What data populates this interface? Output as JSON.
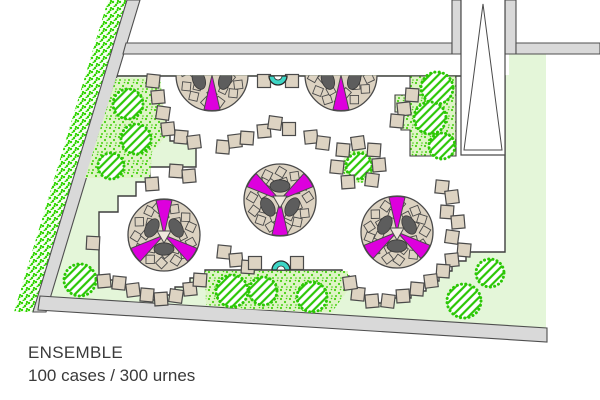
{
  "labels": {
    "title": "ENSEMBLE",
    "subtitle": "100 cases / 300 urnes"
  },
  "colors": {
    "lawn": "#e4f6d9",
    "speckle_bg": "#def4c6",
    "speckle_dot": "#47d112",
    "hedge_dot": "#2fd400",
    "hatch_green": "#2bc705",
    "wall_fill": "#d9d9d9",
    "wall_stroke": "#4f4f4f",
    "boundary": "#3f3f3f",
    "stone": "#ddd3c2",
    "stone_stroke": "#4a4a4a",
    "disc": "#dcd2c1",
    "blob": "#5d5d5d",
    "magenta": "#dd00dd",
    "cyan": "#3dd5c5",
    "white": "#ffffff",
    "text": "#3a3a3a"
  },
  "plan": {
    "lawn": [
      [
        116,
        75
      ],
      [
        509,
        75
      ],
      [
        509,
        54
      ],
      [
        546,
        54
      ],
      [
        546,
        329
      ],
      [
        40,
        297
      ]
    ],
    "walls": {
      "hedge": [
        [
          108,
          0
        ],
        [
          127,
          0
        ],
        [
          33,
          312
        ],
        [
          14,
          312
        ]
      ],
      "street": [
        [
          127,
          0
        ],
        [
          140,
          0
        ],
        [
          46,
          312
        ],
        [
          33,
          312
        ]
      ],
      "top_wall_left": [
        [
          126,
          43
        ],
        [
          452,
          43
        ],
        [
          452,
          54
        ],
        [
          123,
          54
        ]
      ],
      "stub_left": [
        [
          452,
          0
        ],
        [
          461,
          0
        ],
        [
          461,
          54
        ],
        [
          452,
          54
        ]
      ],
      "stub_right": [
        [
          505,
          0
        ],
        [
          516,
          0
        ],
        [
          516,
          54
        ],
        [
          505,
          54
        ]
      ],
      "top_wall_right": [
        [
          516,
          43
        ],
        [
          600,
          43
        ],
        [
          600,
          54
        ],
        [
          516,
          54
        ]
      ],
      "bottom_wall": [
        [
          40,
          296
        ],
        [
          547,
          328
        ],
        [
          547,
          342
        ],
        [
          38,
          310
        ]
      ]
    },
    "paved": [
      [
        117,
        76
      ],
      [
        505,
        76
      ],
      [
        505,
        252
      ],
      [
        466,
        252
      ],
      [
        466,
        261
      ],
      [
        452,
        261
      ],
      [
        452,
        271
      ],
      [
        439,
        271
      ],
      [
        439,
        281
      ],
      [
        426,
        281
      ],
      [
        426,
        291
      ],
      [
        411,
        291
      ],
      [
        411,
        298
      ],
      [
        390,
        298
      ],
      [
        390,
        303
      ],
      [
        369,
        303
      ],
      [
        369,
        296
      ],
      [
        357,
        296
      ],
      [
        357,
        287
      ],
      [
        349,
        287
      ],
      [
        349,
        276
      ],
      [
        342,
        276
      ],
      [
        342,
        270
      ],
      [
        205,
        270
      ],
      [
        205,
        278
      ],
      [
        190,
        278
      ],
      [
        190,
        287
      ],
      [
        175,
        287
      ],
      [
        175,
        295
      ],
      [
        160,
        295
      ],
      [
        160,
        300
      ],
      [
        146,
        300
      ],
      [
        146,
        294
      ],
      [
        132,
        294
      ],
      [
        132,
        287
      ],
      [
        117,
        287
      ],
      [
        117,
        280
      ],
      [
        99,
        280
      ],
      [
        99,
        212
      ],
      [
        118,
        212
      ],
      [
        118,
        196
      ],
      [
        136,
        196
      ],
      [
        136,
        182
      ],
      [
        150,
        182
      ],
      [
        150,
        167
      ],
      [
        196,
        167
      ],
      [
        196,
        141
      ],
      [
        170,
        141
      ],
      [
        170,
        133
      ],
      [
        166,
        133
      ],
      [
        166,
        117
      ],
      [
        161,
        117
      ],
      [
        161,
        101
      ],
      [
        156,
        101
      ],
      [
        156,
        85
      ],
      [
        151,
        85
      ],
      [
        151,
        76
      ]
    ],
    "speckles": [
      [
        [
          116,
          78
        ],
        [
          160,
          78
        ],
        [
          167,
          135
        ],
        [
          152,
          152
        ],
        [
          150,
          178
        ],
        [
          85,
          178
        ]
      ],
      [
        [
          205,
          271
        ],
        [
          348,
          271
        ],
        [
          348,
          290
        ],
        [
          332,
          312
        ],
        [
          240,
          309
        ],
        [
          206,
          305
        ]
      ]
    ],
    "pocket": [
      [
        456,
        76
      ],
      [
        456,
        156
      ],
      [
        410,
        156
      ],
      [
        410,
        130
      ],
      [
        401,
        130
      ],
      [
        401,
        112
      ],
      [
        395,
        112
      ],
      [
        395,
        95
      ],
      [
        410,
        95
      ],
      [
        410,
        76
      ]
    ],
    "speckle_circle": {
      "cx": 359,
      "cy": 166,
      "r": 17
    },
    "corridor": {
      "x": 461,
      "top": 0,
      "w": 44,
      "h": 155,
      "tri": [
        [
          483,
          4
        ],
        [
          464,
          150
        ],
        [
          502,
          150
        ]
      ]
    },
    "rosettes": [
      {
        "cx": 212,
        "cy": 75,
        "r": 36,
        "half": true,
        "wedges": [
          90
        ],
        "blobs": [
          160,
          20
        ],
        "seed": 1
      },
      {
        "cx": 341,
        "cy": 75,
        "r": 36,
        "half": true,
        "wedges": [
          90
        ],
        "blobs": [
          160,
          20
        ],
        "seed": 2
      },
      {
        "cx": 280,
        "cy": 200,
        "r": 36,
        "half": false,
        "wedges": [
          215,
          325,
          90
        ],
        "blobs": [
          270,
          150,
          30
        ],
        "seed": 3
      },
      {
        "cx": 164,
        "cy": 235,
        "r": 36,
        "half": false,
        "wedges": [
          270,
          35,
          145
        ],
        "blobs": [
          90,
          330,
          210
        ],
        "seed": 4
      },
      {
        "cx": 397,
        "cy": 232,
        "r": 36,
        "half": false,
        "wedges": [
          270,
          35,
          145
        ],
        "blobs": [
          90,
          330,
          210
        ],
        "seed": 5
      }
    ],
    "trees": [
      [
        128,
        104,
        15
      ],
      [
        136,
        139,
        15
      ],
      [
        111,
        166,
        13
      ],
      [
        437,
        88,
        16
      ],
      [
        430,
        118,
        16
      ],
      [
        442,
        146,
        13
      ],
      [
        359,
        166,
        13
      ],
      [
        232,
        291,
        16
      ],
      [
        263,
        291,
        14
      ],
      [
        312,
        297,
        15
      ],
      [
        490,
        273,
        14
      ],
      [
        464,
        301,
        17
      ],
      [
        80,
        280,
        16
      ]
    ],
    "stones": [
      [
        153,
        81,
        6
      ],
      [
        158,
        97,
        -5
      ],
      [
        163,
        113,
        8
      ],
      [
        168,
        129,
        -6
      ],
      [
        181,
        137,
        5
      ],
      [
        194,
        142,
        -7
      ],
      [
        176,
        171,
        4
      ],
      [
        189,
        176,
        -5
      ],
      [
        152,
        184,
        -4
      ],
      [
        93,
        243,
        3
      ],
      [
        104,
        281,
        -5
      ],
      [
        119,
        283,
        6
      ],
      [
        133,
        290,
        -7
      ],
      [
        147,
        295,
        5
      ],
      [
        161,
        299,
        -4
      ],
      [
        176,
        296,
        8
      ],
      [
        190,
        289,
        -6
      ],
      [
        200,
        280,
        4
      ],
      [
        224,
        252,
        6
      ],
      [
        236,
        260,
        -5
      ],
      [
        248,
        267,
        4
      ],
      [
        255,
        263,
        0
      ],
      [
        297,
        263,
        0
      ],
      [
        264,
        81,
        0
      ],
      [
        292,
        81,
        0
      ],
      [
        223,
        147,
        5
      ],
      [
        235,
        141,
        -7
      ],
      [
        247,
        138,
        4
      ],
      [
        264,
        131,
        -5
      ],
      [
        275,
        123,
        8
      ],
      [
        289,
        129,
        0
      ],
      [
        311,
        137,
        -6
      ],
      [
        323,
        143,
        7
      ],
      [
        343,
        150,
        5
      ],
      [
        358,
        143,
        -8
      ],
      [
        374,
        150,
        4
      ],
      [
        379,
        165,
        -5
      ],
      [
        372,
        180,
        7
      ],
      [
        348,
        182,
        -4
      ],
      [
        337,
        167,
        6
      ],
      [
        412,
        95,
        4
      ],
      [
        404,
        109,
        -6
      ],
      [
        397,
        121,
        5
      ],
      [
        442,
        187,
        6
      ],
      [
        452,
        197,
        -7
      ],
      [
        447,
        212,
        4
      ],
      [
        458,
        222,
        -5
      ],
      [
        452,
        237,
        8
      ],
      [
        464,
        250,
        5
      ],
      [
        452,
        260,
        -6
      ],
      [
        443,
        271,
        4
      ],
      [
        431,
        281,
        -7
      ],
      [
        417,
        289,
        5
      ],
      [
        403,
        296,
        -4
      ],
      [
        388,
        301,
        7
      ],
      [
        372,
        301,
        -5
      ],
      [
        358,
        294,
        6
      ],
      [
        350,
        283,
        -8
      ]
    ],
    "fountains": [
      {
        "cx": 278,
        "y": 76,
        "bulge": "down",
        "r": 9
      },
      {
        "cx": 281,
        "y": 270,
        "bulge": "up",
        "r": 9
      }
    ],
    "stone_size": 13,
    "wedge_half_angle": 13
  }
}
